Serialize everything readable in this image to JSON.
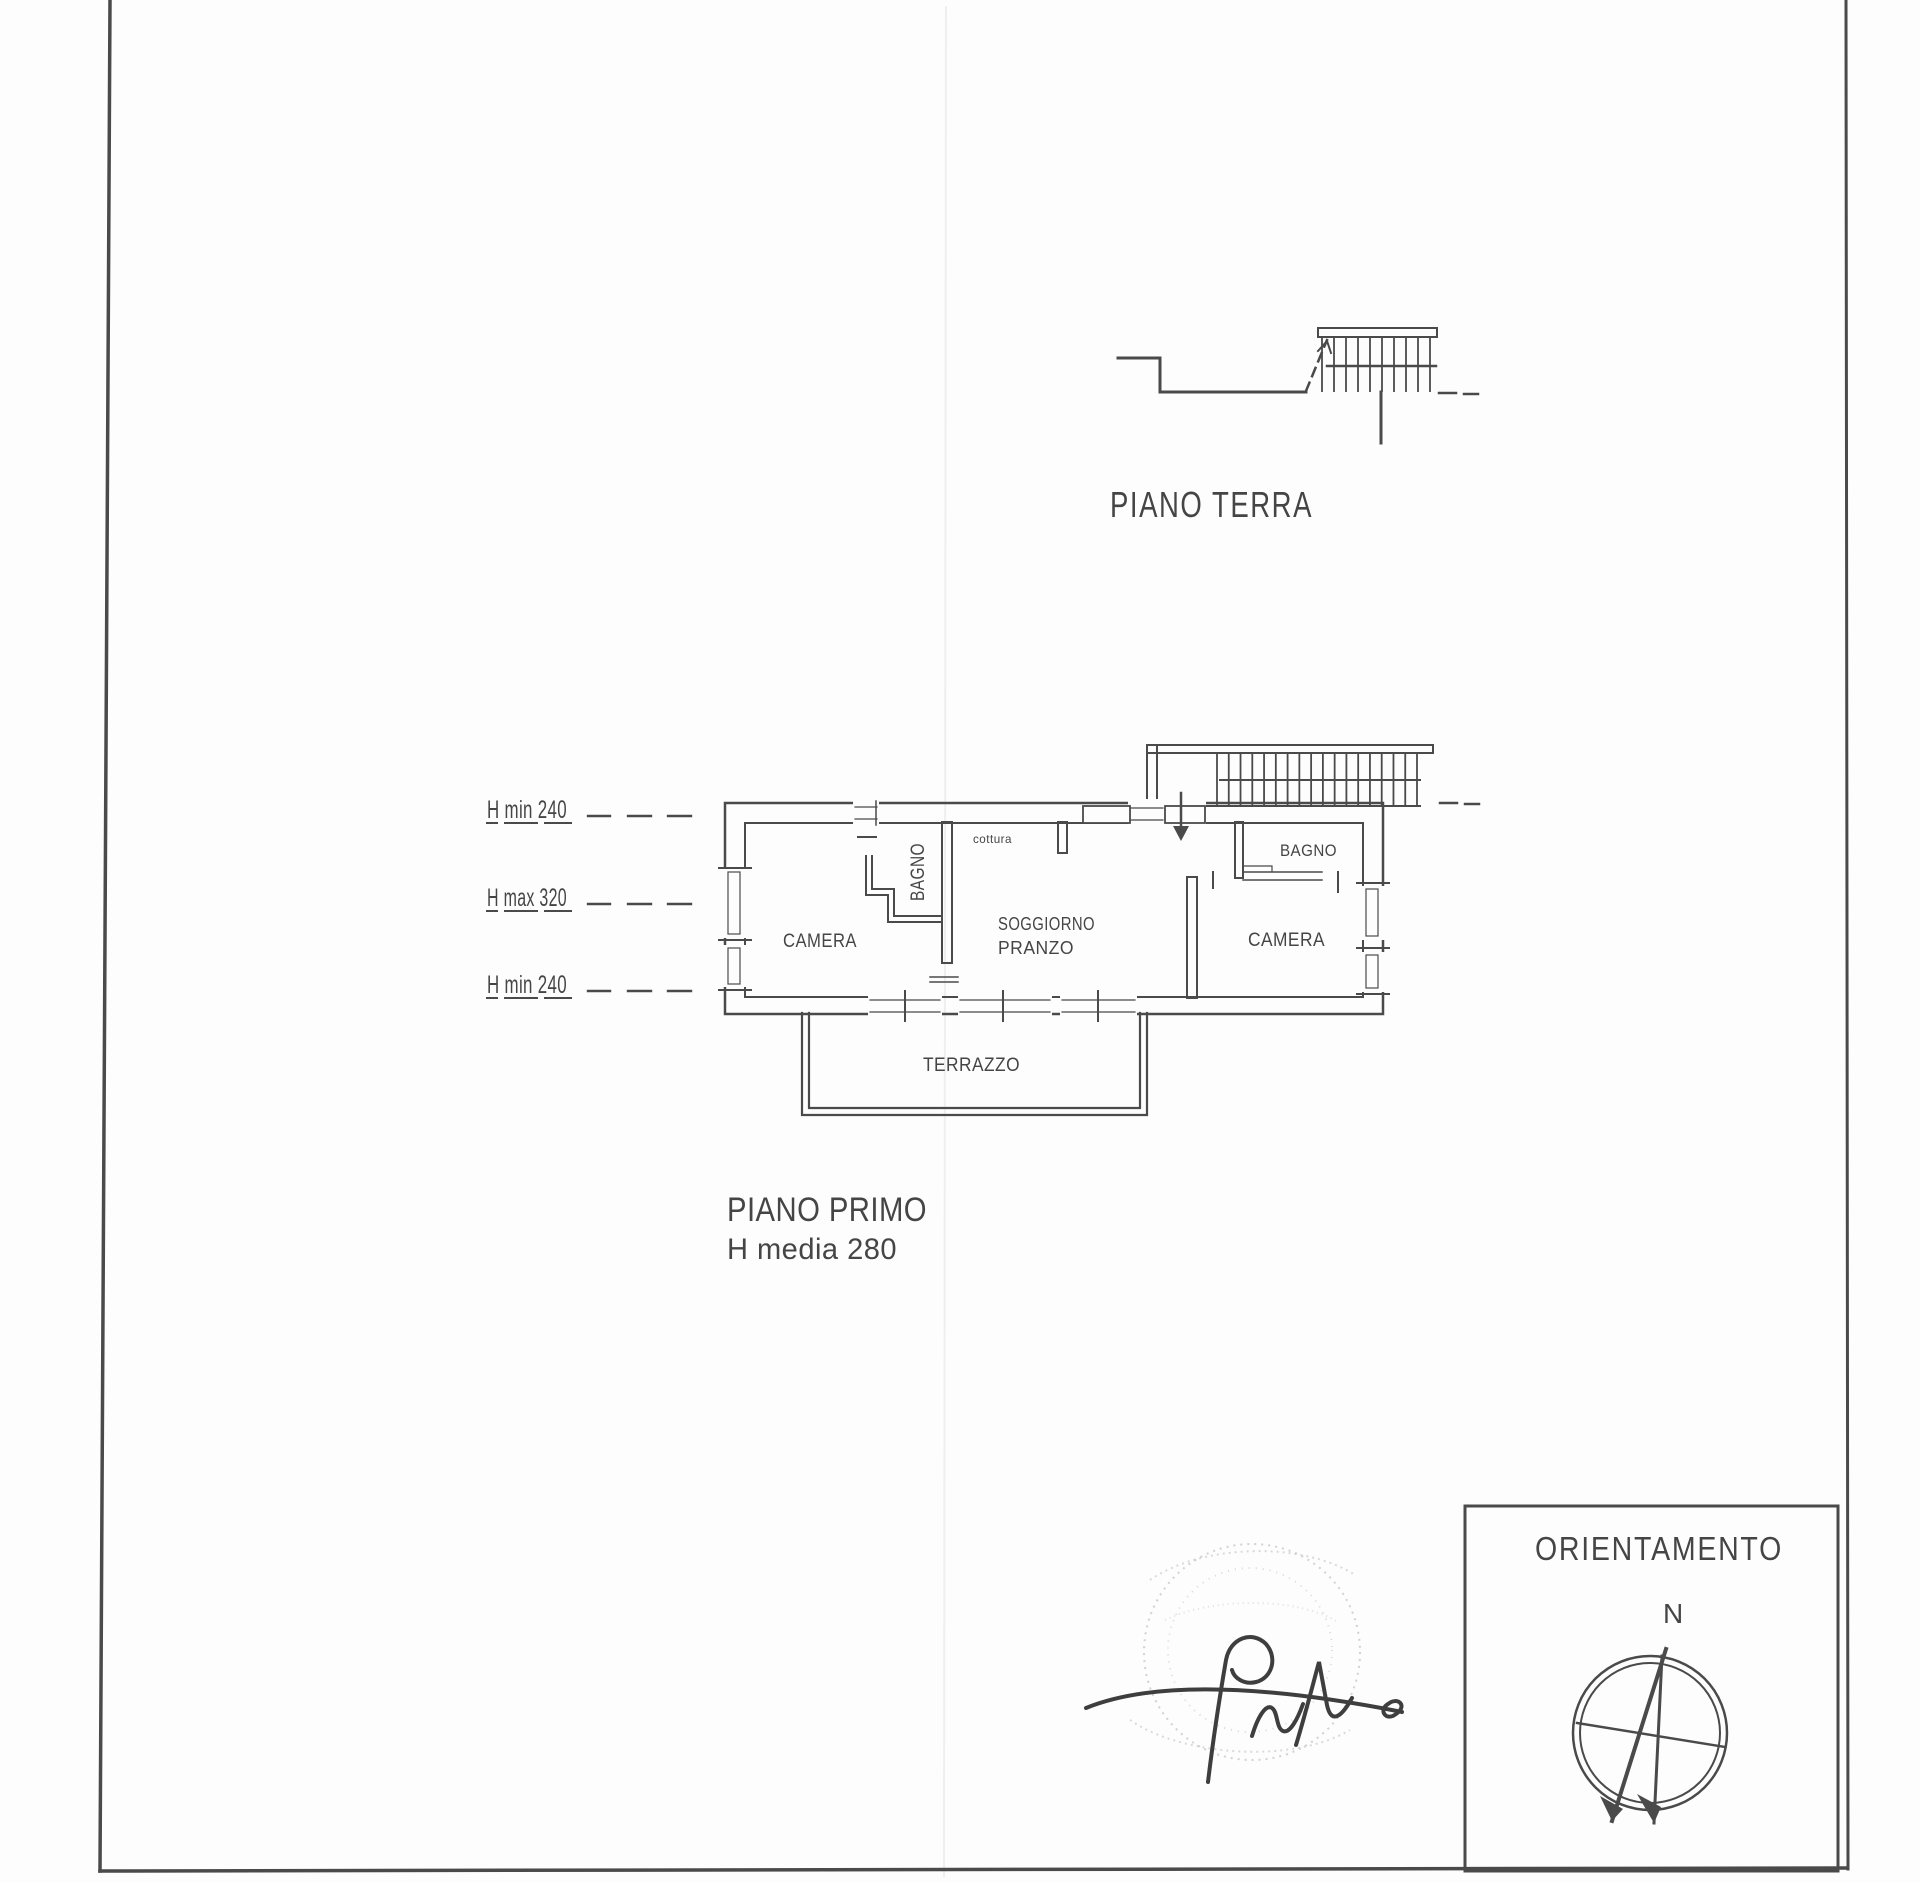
{
  "colors": {
    "ink": "#4a4a4a",
    "paper": "#fdfdfd",
    "faint": "#c3c3c3"
  },
  "floors": {
    "ground": {
      "label": "PIANO TERRA"
    },
    "first": {
      "label": "PIANO PRIMO",
      "height_note": "H media 280"
    }
  },
  "height_annotations": [
    {
      "label": "H min 240"
    },
    {
      "label": "H max 320"
    },
    {
      "label": "H min 240"
    }
  ],
  "rooms": {
    "camera_left": "CAMERA",
    "bagno_left": "BAGNO",
    "cottura": "cottura",
    "soggiorno_line1": "SOGGIORNO",
    "soggiorno_line2": "PRANZO",
    "bagno_right": "BAGNO",
    "camera_right": "CAMERA",
    "terrazzo": "TERRAZZO"
  },
  "orientation": {
    "title": "ORIENTAMENTO",
    "north_label": "N"
  }
}
